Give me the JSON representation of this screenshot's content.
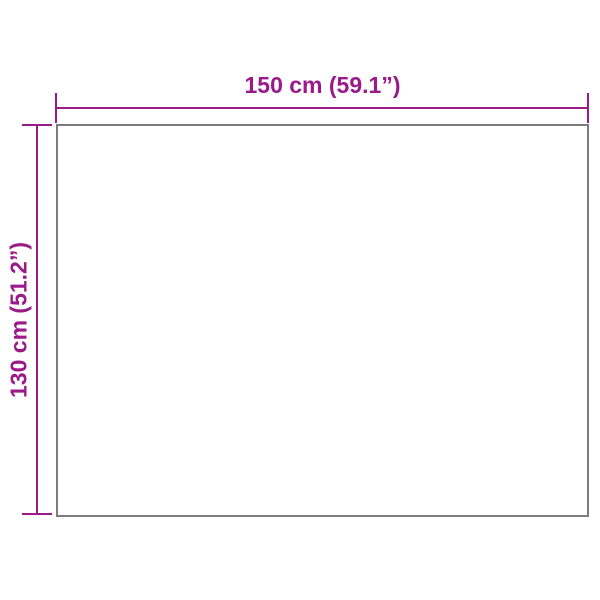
{
  "diagram": {
    "type": "product-dimensions",
    "width_dimension": {
      "label": "150 cm (59.1”)",
      "value_cm": 150,
      "value_inches": 59.1
    },
    "height_dimension": {
      "label": "130 cm (51.2”)",
      "value_cm": 130,
      "value_inches": 51.2
    },
    "colors": {
      "dimension_accent": "#9a1a8a",
      "outline_gray": "#7c7c7c",
      "background": "#ffffff"
    }
  }
}
